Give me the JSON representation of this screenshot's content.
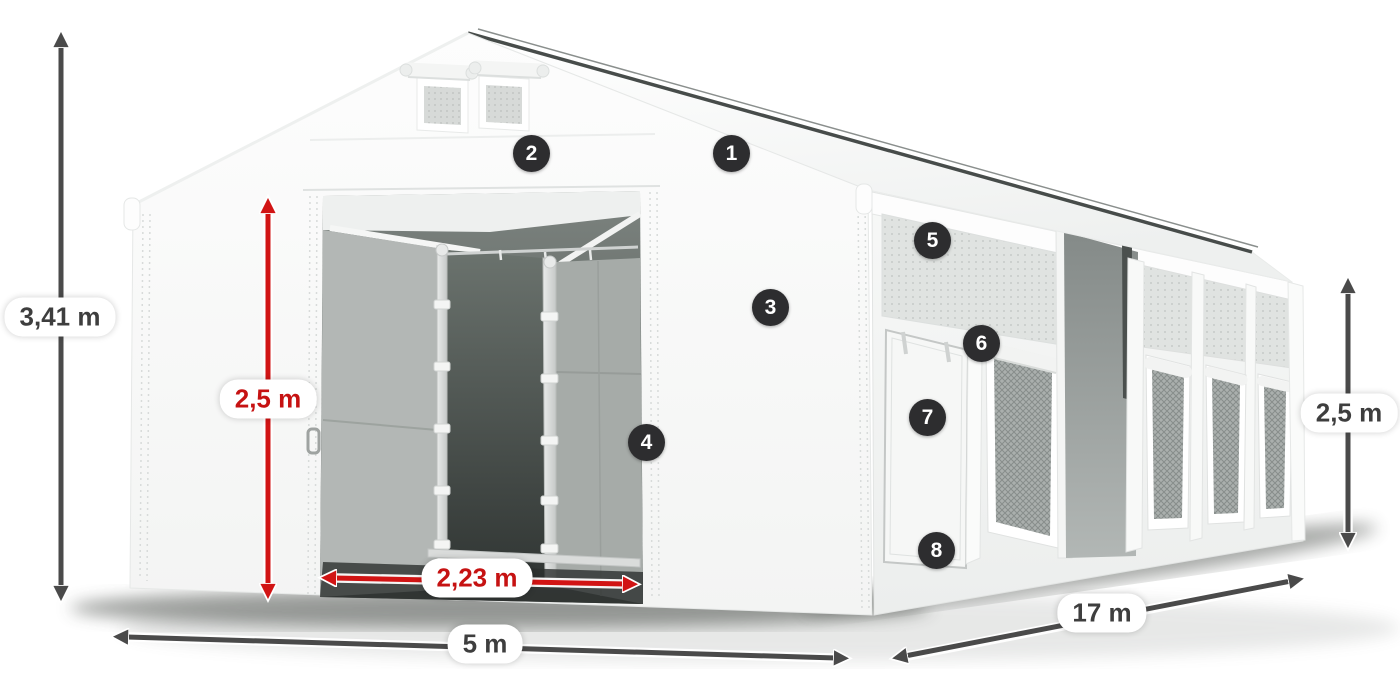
{
  "diagram": {
    "subject": "storage-tent-with-dimensions",
    "colors": {
      "accent_red": "#c61212",
      "arrow_dark": "#4a4a4a",
      "badge_background": "#2d2d2f",
      "tent_white": "#fbfbfb",
      "interior_gray": "#a6aba8"
    },
    "dimensions": {
      "total_height": {
        "label": "3,41 m"
      },
      "door_height": {
        "label": "2,5 m"
      },
      "door_width": {
        "label": "2,23 m"
      },
      "front_width": {
        "label": "5 m"
      },
      "length": {
        "label": "17 m"
      },
      "side_height": {
        "label": "2,5 m"
      }
    },
    "callouts": [
      {
        "number": "1"
      },
      {
        "number": "2"
      },
      {
        "number": "3"
      },
      {
        "number": "4"
      },
      {
        "number": "5"
      },
      {
        "number": "6"
      },
      {
        "number": "7"
      },
      {
        "number": "8"
      }
    ]
  }
}
